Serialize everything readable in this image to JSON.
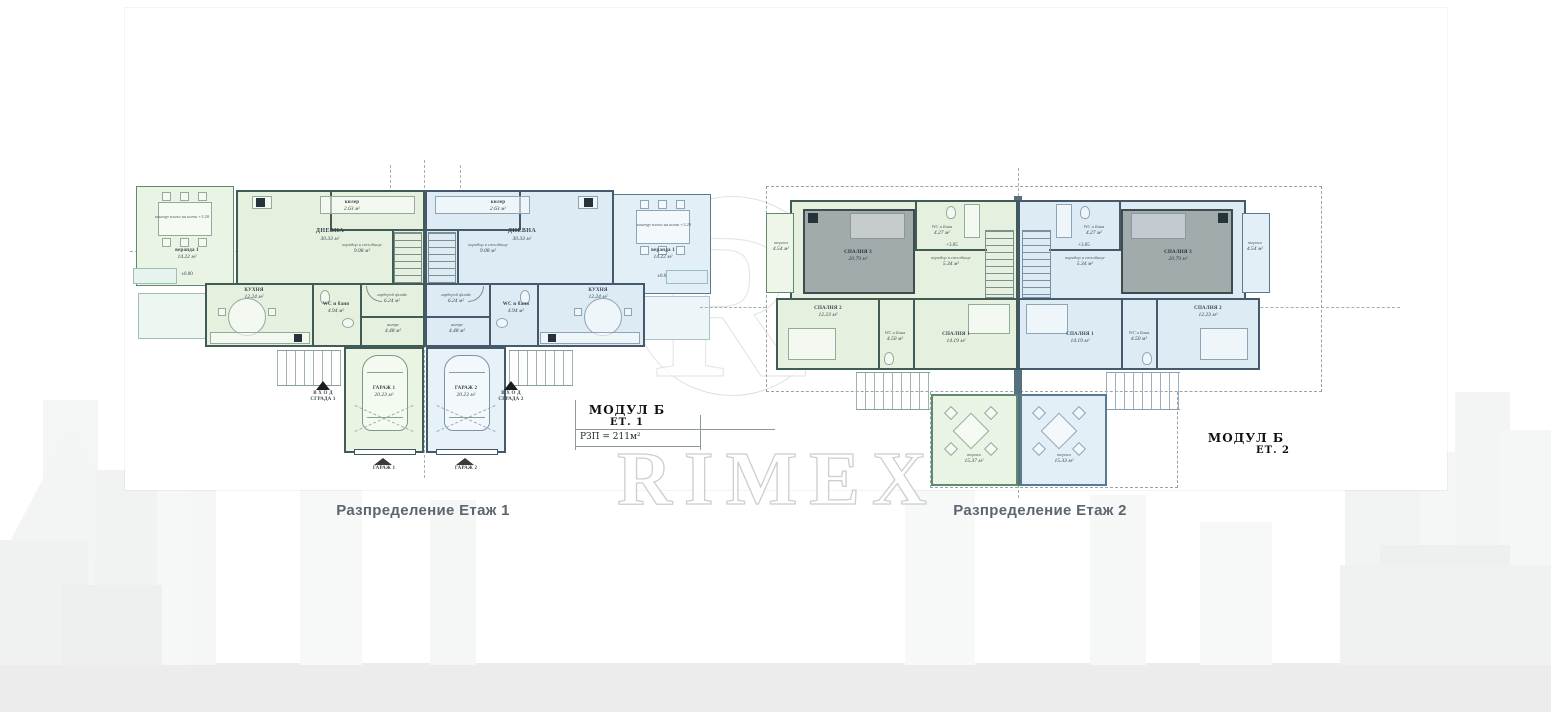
{
  "brand": {
    "watermark_text": "RIMEX",
    "logo_letter": "R"
  },
  "captions": {
    "floor1": "Разпределение Етаж 1",
    "floor2": "Разпределение Етаж 2"
  },
  "modules": {
    "floor1": {
      "title": "МОДУЛ Б",
      "floor": "ЕТ. 1",
      "rzp": "РЗП = 211м²"
    },
    "floor2": {
      "title": "МОДУЛ Б",
      "floor": "ЕТ. 2"
    }
  },
  "floor1": {
    "unit1": {
      "terrace": {
        "label": "веранда 1",
        "area": "14.22 м²",
        "note": "контур плоча на кота +3.20",
        "level": "±0.00"
      },
      "rooms": [
        {
          "label": "ДНЕВНА",
          "area": "30.33 м²"
        },
        {
          "label": "КУХНЯ",
          "area": "12.24 м²"
        },
        {
          "label": "WC и баня",
          "area": "4.94 м²"
        },
        {
          "label": "килер",
          "area": "2.63 м²"
        },
        {
          "label": "коридор и стълбище",
          "area": "9.08 м²"
        },
        {
          "label": "гардероб фоайе",
          "area": "6.24 м²"
        },
        {
          "label": "антре",
          "area": "4.48 м²"
        },
        {
          "label": "ГАРАЖ 1",
          "area": "20.23 м²"
        }
      ],
      "entrance": {
        "line1": "В Х О Д",
        "line2": "СГРАДА 1"
      },
      "garage_door": "ГАРАЖ 1"
    },
    "unit2": {
      "terrace": {
        "label": "веранда 1",
        "area": "14.22 м²",
        "note": "контур плоча на кота +3.20",
        "level": "±0.00"
      },
      "rooms": [
        {
          "label": "ДНЕВНА",
          "area": "30.33 м²"
        },
        {
          "label": "КУХНЯ",
          "area": "12.24 м²"
        },
        {
          "label": "WC и баня",
          "area": "4.94 м²"
        },
        {
          "label": "килер",
          "area": "2.63 м²"
        },
        {
          "label": "коридор и стълбище",
          "area": "9.08 м²"
        },
        {
          "label": "гардероб фоайе",
          "area": "6.24 м²"
        },
        {
          "label": "антре",
          "area": "4.48 м²"
        },
        {
          "label": "ГАРАЖ 2",
          "area": "20.23 м²"
        }
      ],
      "entrance": {
        "line1": "В Х О Д",
        "line2": "СГРАДА 2"
      },
      "garage_door": "ГАРАЖ 2"
    }
  },
  "floor2": {
    "level": "+3.05",
    "unit1": {
      "rooms": [
        {
          "label": "тераса",
          "area": "4.54 м²"
        },
        {
          "label": "СПАЛНЯ 3",
          "area": "20.79 м²"
        },
        {
          "label": "WC и Баня",
          "area": "4.27 м²"
        },
        {
          "label": "коридор и стълбище",
          "area": "5.34 м²"
        },
        {
          "label": "СПАЛНЯ 2",
          "area": "12.23 м²"
        },
        {
          "label": "WC и Баня",
          "area": "4.50 м²"
        },
        {
          "label": "СПАЛНЯ 1",
          "area": "14.19 м²"
        },
        {
          "label": "тераса",
          "area": "15.37 м²"
        }
      ]
    },
    "unit2": {
      "rooms": [
        {
          "label": "тераса",
          "area": "4.54 м²"
        },
        {
          "label": "СПАЛНЯ 3",
          "area": "20.79 м²"
        },
        {
          "label": "WC и Баня",
          "area": "4.27 м²"
        },
        {
          "label": "коридор и стълбище",
          "area": "5.34 м²"
        },
        {
          "label": "СПАЛНЯ 2",
          "area": "12.23 м²"
        },
        {
          "label": "WC и Баня",
          "area": "4.50 м²"
        },
        {
          "label": "СПАЛНЯ 1",
          "area": "14.19 м²"
        },
        {
          "label": "тераса",
          "area": "15.33 м²"
        }
      ]
    }
  },
  "colors": {
    "unit_green_fill": "#e5f0df",
    "unit_blue_fill": "#dcebf4",
    "wall_green": "#415c55",
    "wall_blue": "#44596b",
    "bedroom_gray": "#a2abac",
    "caption_text": "#5c6670"
  }
}
